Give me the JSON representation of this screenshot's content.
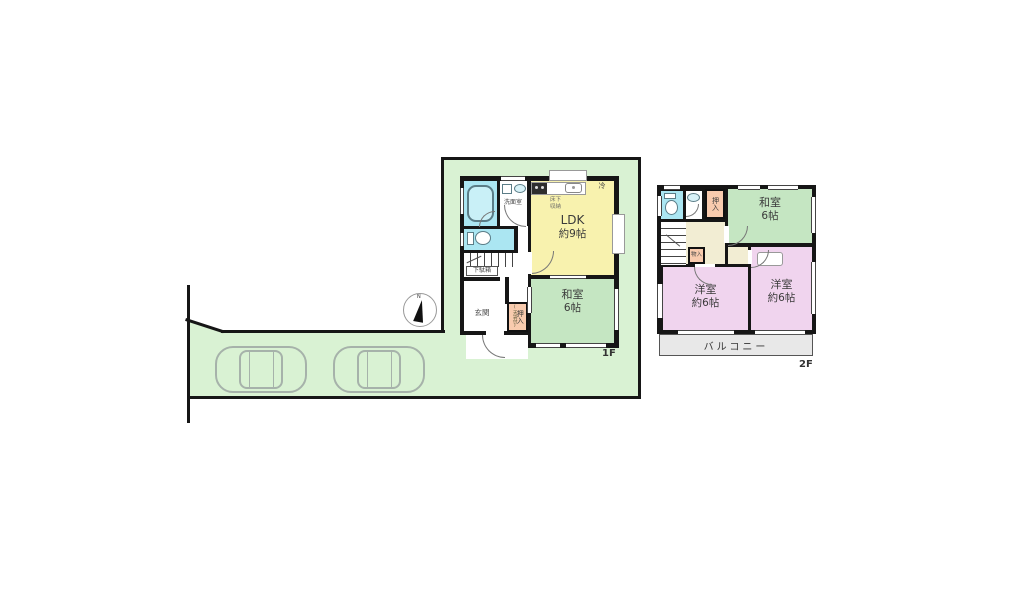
{
  "site": {
    "compass_label": "N",
    "cars": 2
  },
  "floor1": {
    "label": "1F",
    "ldk": {
      "name": "LDK",
      "size": "約9帖"
    },
    "washitsu": {
      "name": "和室",
      "size": "6帖"
    },
    "genkan": "玄関",
    "senmen": "洗面室",
    "getabako": "下駄箱",
    "oshiire": "押入",
    "oshiire_note": "(天袋付)",
    "yukashita": "床下収納",
    "rei": "冷"
  },
  "floor2": {
    "label": "2F",
    "washitsu": {
      "name": "和室",
      "size": "6帖"
    },
    "yoshitsu_left": {
      "name": "洋室",
      "size": "約6帖"
    },
    "yoshitsu_right": {
      "name": "洋室",
      "size": "約6帖"
    },
    "oshiire": "押入",
    "monoire": "物入",
    "balcony": "バルコニー"
  },
  "colors": {
    "site_green": "#d9f2d3",
    "room_yellow": "#f8f2ae",
    "room_green": "#c5e6c2",
    "room_pink": "#f0d4ee",
    "closet_salmon": "#f8cbae",
    "water_cyan": "#abe6f2",
    "hall_cream": "#f2edd3",
    "balcony_gray": "#e8e8e8",
    "wall": "#161616"
  }
}
